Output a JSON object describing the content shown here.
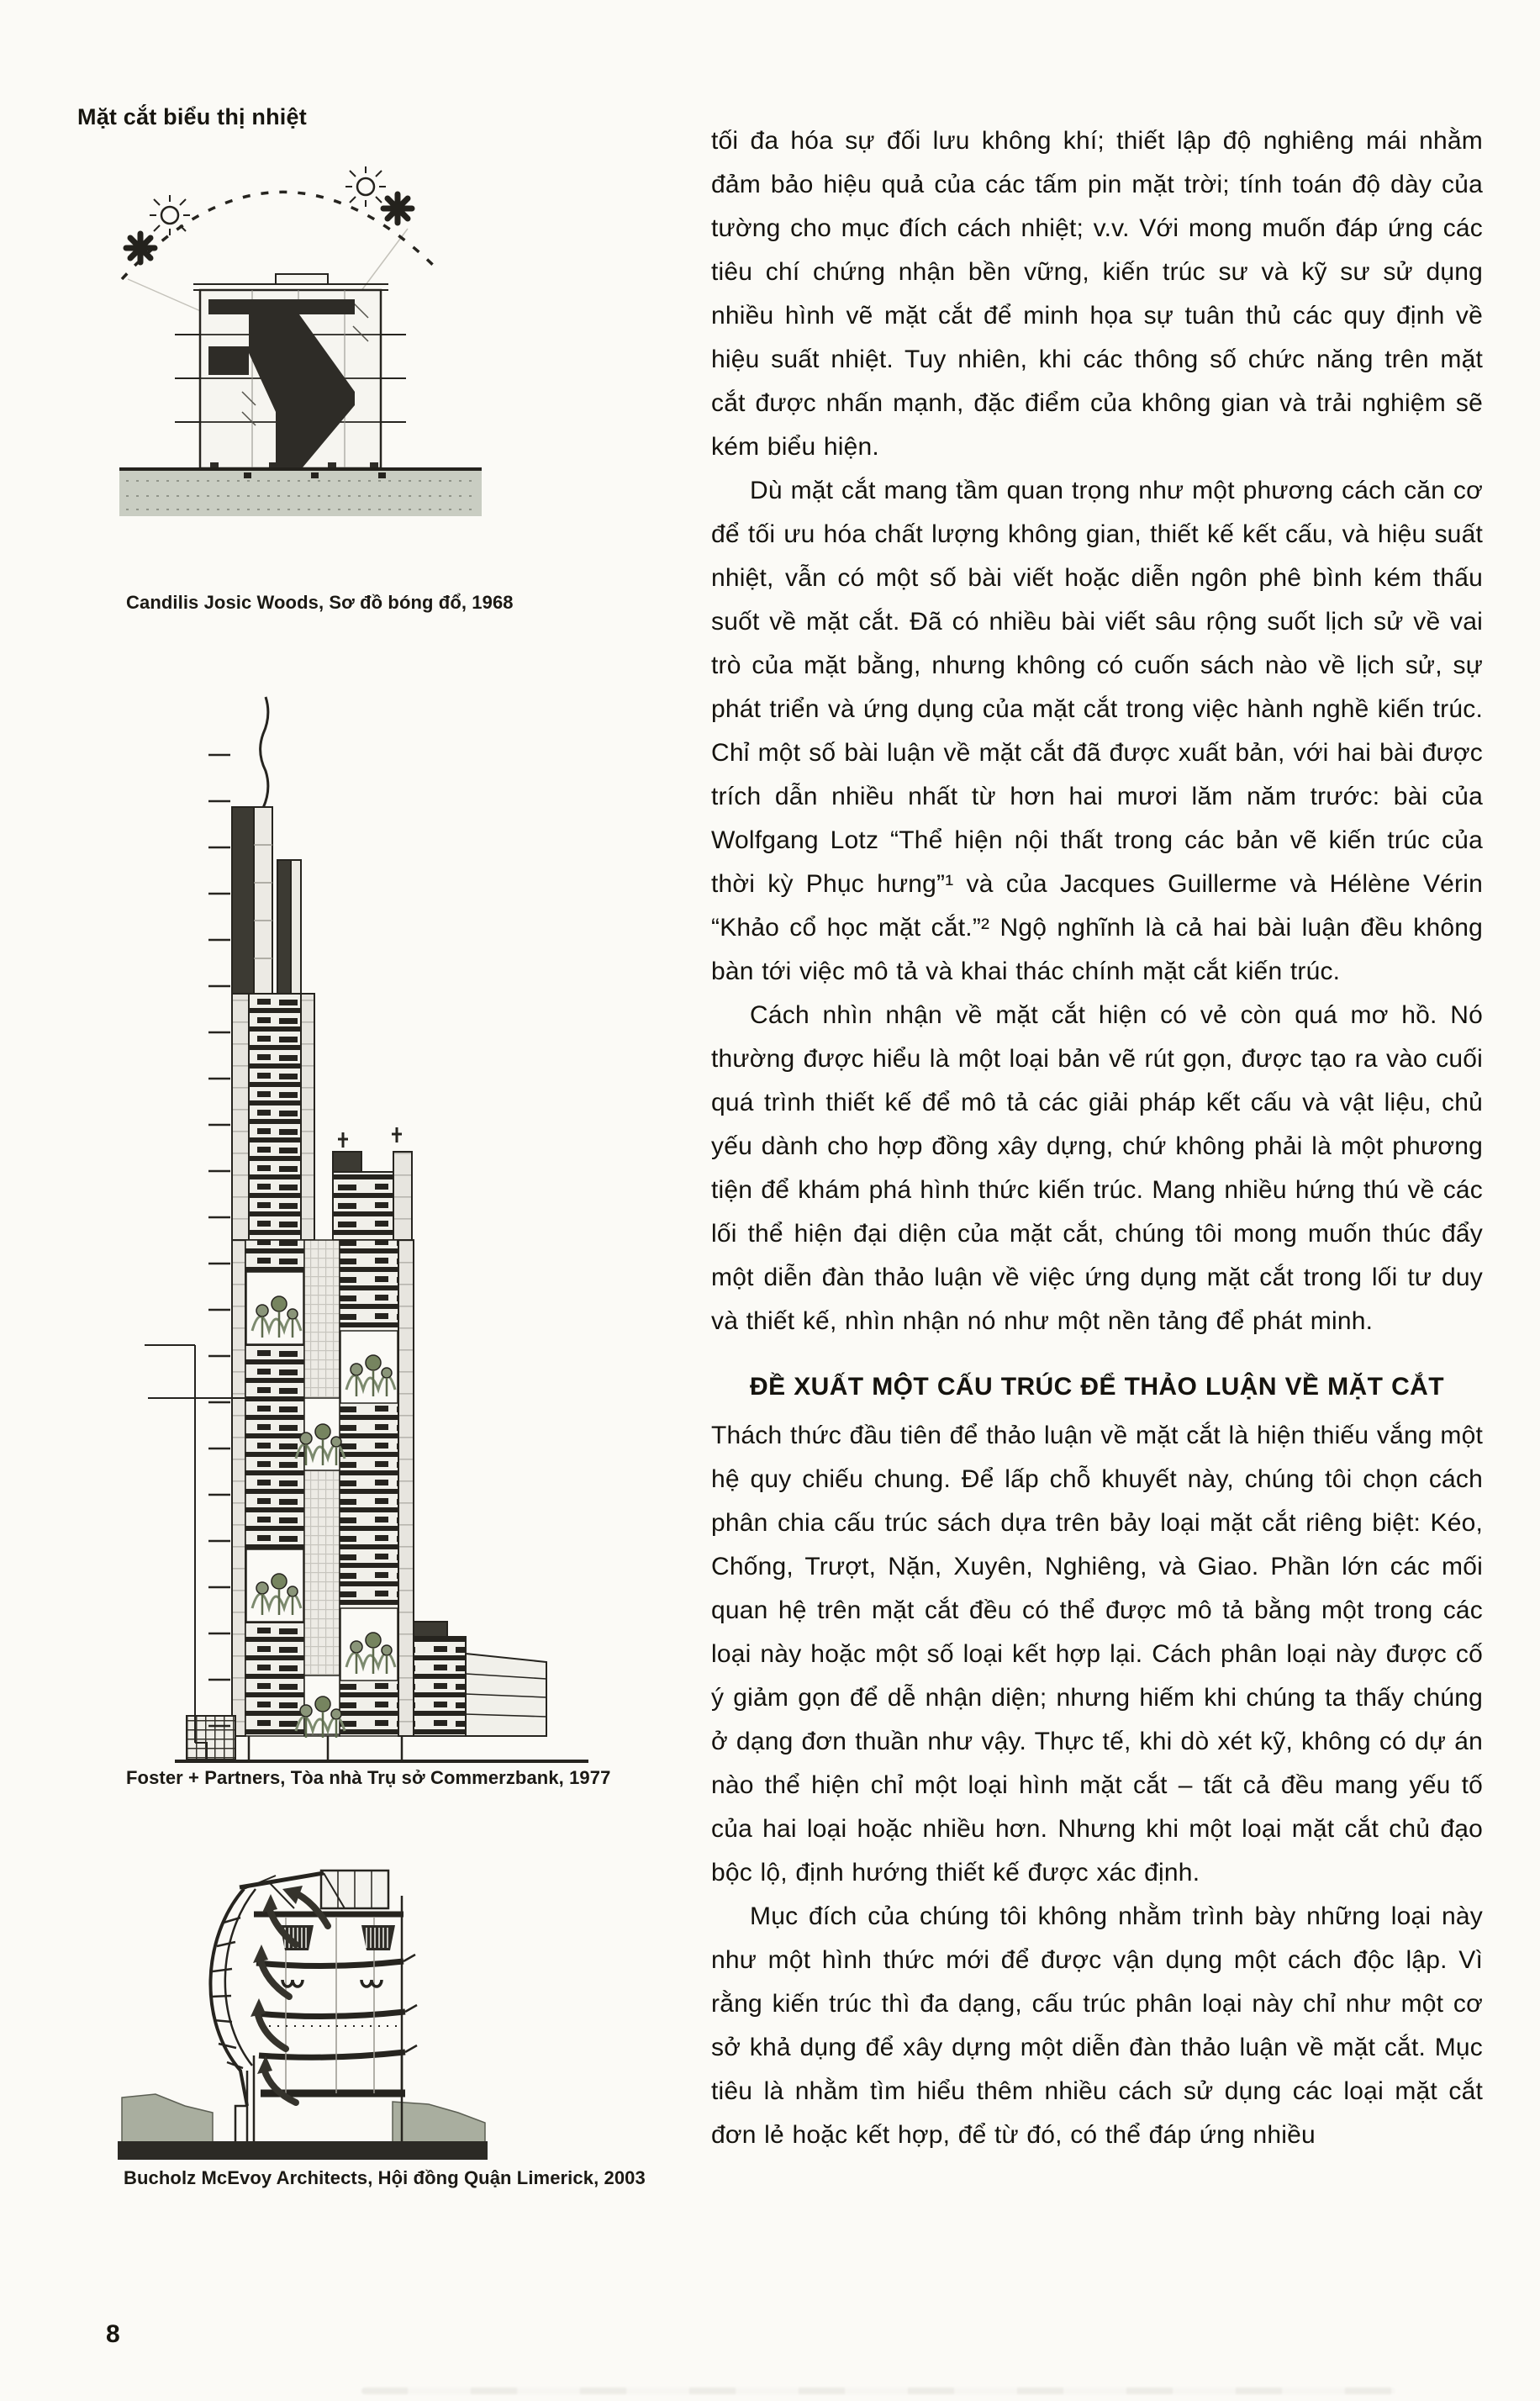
{
  "left_column": {
    "heading": "Mặt cắt biểu thị nhiệt",
    "figures": [
      {
        "name": "shadow-diagram",
        "caption": "Candilis Josic Woods, Sơ đồ bóng đổ, 1968"
      },
      {
        "name": "commerzbank-tower-section",
        "caption": "Foster + Partners, Tòa nhà Trụ sở Commerzbank, 1977"
      },
      {
        "name": "limerick-council-section",
        "caption": "Bucholz McEvoy Architects, Hội đồng Quận Limerick, 2003"
      }
    ],
    "icons": [
      "sun-icon",
      "star-burst-icon",
      "sun-path-arc"
    ]
  },
  "main": {
    "paragraphs": [
      {
        "indent": false,
        "text": "tối đa hóa sự đối lưu không khí; thiết lập độ nghiêng mái nhằm đảm bảo hiệu quả của các tấm pin mặt trời; tính toán độ dày của tường cho mục đích cách nhiệt; v.v. Với mong muốn đáp ứng các tiêu chí chứng nhận bền vững, kiến trúc sư và kỹ sư sử dụng nhiều hình vẽ mặt cắt để minh họa sự tuân thủ các quy định về hiệu suất nhiệt. Tuy nhiên, khi các thông số chức năng trên mặt cắt được nhấn mạnh, đặc điểm của không gian và trải nghiệm sẽ kém biểu hiện."
      },
      {
        "indent": true,
        "text": "Dù mặt cắt mang tầm quan trọng như một phương cách căn cơ để tối ưu hóa chất lượng không gian, thiết kế kết cấu, và hiệu suất nhiệt, vẫn có một số bài viết hoặc diễn ngôn phê bình kém thấu suốt về mặt cắt. Đã có nhiều bài viết sâu rộng suốt lịch sử về vai trò của mặt bằng, nhưng không có cuốn sách nào về lịch sử, sự phát triển và ứng dụng của mặt cắt trong việc hành nghề kiến trúc. Chỉ một số bài luận về mặt cắt đã được xuất bản, với hai bài được trích dẫn nhiều nhất từ hơn hai mươi lăm năm trước: bài của Wolfgang Lotz “Thể hiện nội thất trong các bản vẽ kiến trúc của thời kỳ Phục hưng”¹ và của Jacques Guillerme và Hélène Vérin “Khảo cổ học mặt cắt.”² Ngộ nghĩnh là cả hai bài luận đều không bàn tới việc mô tả và khai thác chính mặt cắt kiến trúc."
      },
      {
        "indent": true,
        "text": "Cách nhìn nhận về mặt cắt hiện có vẻ còn quá mơ hồ. Nó thường được hiểu là một loại bản vẽ rút gọn, được tạo ra vào cuối quá trình thiết kế để mô tả các giải pháp kết cấu và vật liệu, chủ yếu dành cho hợp đồng xây dựng, chứ không phải là một phương tiện để khám phá hình thức kiến trúc. Mang nhiều hứng thú về các lối thể hiện đại diện của mặt cắt, chúng tôi mong muốn thúc đẩy một diễn đàn thảo luận về việc ứng dụng mặt cắt trong lối tư duy và thiết kế, nhìn nhận nó như một nền tảng để phát minh."
      },
      {
        "indent": false,
        "text": "Thách thức đầu tiên để thảo luận về mặt cắt là hiện thiếu vắng một hệ quy chiếu chung. Để lấp chỗ khuyết này, chúng tôi chọn cách phân chia cấu trúc sách dựa trên bảy loại mặt cắt riêng biệt: Kéo, Chống, Trượt, Nặn, Xuyên, Nghiêng, và Giao. Phần lớn các mối quan hệ trên mặt cắt đều có thể được mô tả bằng một trong các loại này hoặc một số loại kết hợp lại. Cách phân loại này được cố ý giảm gọn để dễ nhận diện; nhưng hiếm khi chúng ta thấy chúng ở dạng đơn thuần như vậy. Thực tế, khi dò xét kỹ, không có dự án nào thể hiện chỉ một loại hình mặt cắt – tất cả đều mang yếu tố của hai loại hoặc nhiều hơn. Nhưng khi một loại mặt cắt chủ đạo bộc lộ, định hướng thiết kế được xác định."
      },
      {
        "indent": true,
        "text": "Mục đích của chúng tôi không nhằm trình bày những loại này như một hình thức mới để được vận dụng một cách độc lập. Vì rằng kiến trúc thì đa dạng, cấu trúc phân loại này chỉ như một cơ sở khả dụng để xây dựng một diễn đàn thảo luận về mặt cắt. Mục tiêu là nhằm tìm hiểu thêm nhiều cách sử dụng các loại mặt cắt đơn lẻ hoặc kết hợp, để từ đó, có thể đáp ứng nhiều"
      }
    ],
    "section_heading": "ĐỀ XUẤT MỘT CẤU TRÚC ĐỂ THẢO LUẬN VỀ MẶT CẮT"
  },
  "footer": {
    "page_number": "8"
  },
  "colors": {
    "paper": "#fbfaf6",
    "ink": "#26241f",
    "dark_fill": "#2e2c27",
    "ground_gray": "#c9cdc2",
    "terrain_gray": "#a9ae9f",
    "greenery": "#7c8a6e"
  }
}
